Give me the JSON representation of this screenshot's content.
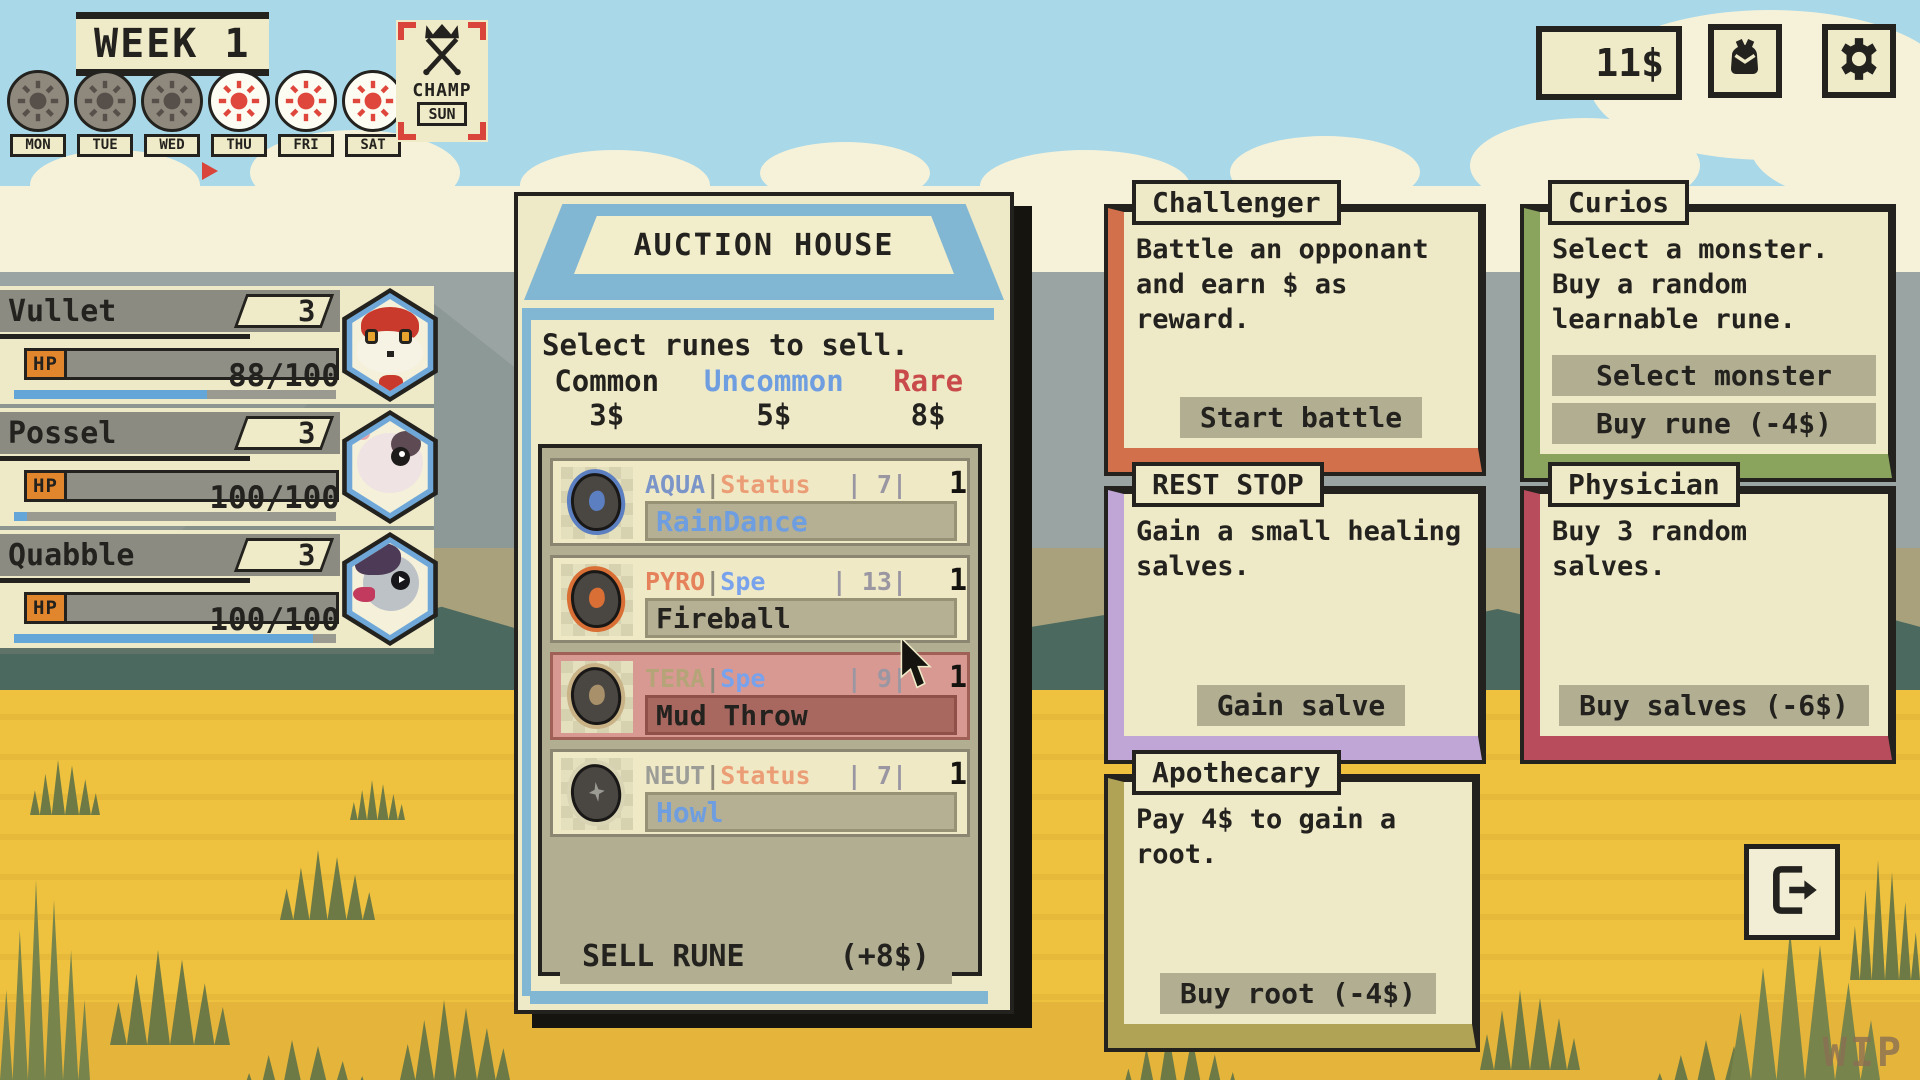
{
  "header": {
    "week_label": "WEEK 1",
    "days": [
      {
        "label": "MON",
        "state": "past"
      },
      {
        "label": "TUE",
        "state": "past"
      },
      {
        "label": "WED",
        "state": "past"
      },
      {
        "label": "THU",
        "state": "upcoming"
      },
      {
        "label": "FRI",
        "state": "upcoming"
      },
      {
        "label": "SAT",
        "state": "upcoming"
      }
    ],
    "champ": {
      "title": "CHAMP",
      "day": "SUN"
    },
    "money": "11$"
  },
  "icons": {
    "bag": "bag-icon",
    "settings": "gear-icon",
    "exit": "exit-door-icon",
    "champ_emblem": "crown-crossed-swords-icon",
    "day": "sun-icon",
    "cursor": "mouse-cursor"
  },
  "party": [
    {
      "name": "Vullet",
      "level": "3",
      "hp_label": "HP",
      "hp_text": "88/100",
      "hp_pct": 88,
      "xp_pct": 60
    },
    {
      "name": "Possel",
      "level": "3",
      "hp_label": "HP",
      "hp_text": "100/100",
      "hp_pct": 100,
      "xp_pct": 4
    },
    {
      "name": "Quabble",
      "level": "3",
      "hp_label": "HP",
      "hp_text": "100/100",
      "hp_pct": 100,
      "xp_pct": 93
    }
  ],
  "auction": {
    "title": "AUCTION HOUSE",
    "subtitle": "Select runes to sell.",
    "rarities": [
      {
        "label": "Common",
        "price": "3$",
        "color": "#23221e"
      },
      {
        "label": "Uncommon",
        "price": "5$",
        "color": "#6f9ee0"
      },
      {
        "label": "Rare",
        "price": "8$",
        "color": "#c94a4a"
      }
    ],
    "runes": [
      {
        "type": "AQUA",
        "type_color": "#7b95c9",
        "category": "Status",
        "category_color": "#eb9d75",
        "power": "7",
        "qty": "1",
        "name": "RainDance",
        "name_color": "#6f9ee0",
        "selected": false
      },
      {
        "type": "PYRO",
        "type_color": "#e5825b",
        "category": "Spe",
        "category_color": "#79a2ec",
        "power": "13",
        "qty": "1",
        "name": "Fireball",
        "name_color": "#23221e",
        "selected": false
      },
      {
        "type": "TERA",
        "type_color": "#b5a478",
        "category": "Spe",
        "category_color": "#79a2ec",
        "power": "9",
        "qty": "1",
        "name": "Mud Throw",
        "name_color": "#23221e",
        "selected": true
      },
      {
        "type": "NEUT",
        "type_color": "#9d9d98",
        "category": "Status",
        "category_color": "#eb9d75",
        "power": "7",
        "qty": "1",
        "name": "Howl",
        "name_color": "#6f9ee0",
        "selected": false
      }
    ],
    "sell_label": "SELL RUNE",
    "sell_price": "(+8$)"
  },
  "shops": [
    {
      "title": "Challenger",
      "description": "Battle an opponant and earn $ as reward.",
      "buttons": [
        "Start battle"
      ],
      "accent": "#d2704b"
    },
    {
      "title": "Curios",
      "description": "Select a monster. Buy a random learnable rune.",
      "buttons": [
        "Select monster",
        "Buy rune (-4$)"
      ],
      "accent": "#8aa45e"
    },
    {
      "title": "REST STOP",
      "description": "Gain a small healing salves.",
      "buttons": [
        "Gain salve"
      ],
      "accent": "#c0a6d6"
    },
    {
      "title": "Physician",
      "description": "Buy 3 random salves.",
      "buttons": [
        "Buy salves (-6$)"
      ],
      "accent": "#b94c5c"
    },
    {
      "title": "Apothecary",
      "description": "Pay 4$ to gain a root.",
      "buttons": [
        "Buy root (-4$)"
      ],
      "accent": "#b1a356"
    }
  ],
  "watermark": "WIP"
}
